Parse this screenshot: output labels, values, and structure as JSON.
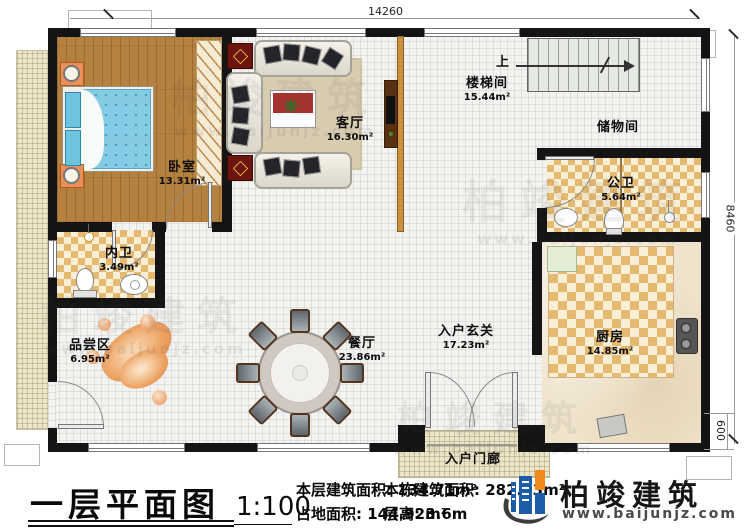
{
  "floorplan": {
    "dim_top": "14260",
    "dim_right": "8460",
    "dim_porch": "600",
    "stairs_up": "上",
    "rooms": {
      "bedroom": {
        "name": "卧室",
        "area": "13.31m²"
      },
      "living": {
        "name": "客厅",
        "area": "16.30m²"
      },
      "stairwell": {
        "name": "楼梯间",
        "area": "15.44m²"
      },
      "storage": {
        "name": "储物间"
      },
      "public_bath": {
        "name": "公卫",
        "area": "5.64m²"
      },
      "private_bath": {
        "name": "内卫",
        "area": "3.49m²"
      },
      "tasting": {
        "name": "品尝区",
        "area": "6.95m²"
      },
      "dining": {
        "name": "餐厅",
        "area": "23.86m²"
      },
      "foyer": {
        "name": "入户玄关",
        "area": "17.23m²"
      },
      "kitchen": {
        "name": "厨房",
        "area": "14.85m²"
      },
      "porch": {
        "name": "入户门廊"
      }
    }
  },
  "footer": {
    "title": "一层平面图",
    "scale": "1:100",
    "stats": {
      "floor_area_label": "本层建筑面积:",
      "floor_area_value": "134.71m²",
      "land_area_label": "占地面积:",
      "land_area_value": "144.92m²",
      "total_area_label": "本栋建筑面积:",
      "total_area_value": "282.03m²",
      "height_label": "层高:",
      "height_value": "3.6m"
    },
    "brand": {
      "name": "柏竣建筑",
      "website": "www.baijunjz.com"
    }
  },
  "watermark": {
    "name": "柏竣建筑",
    "website": "www.baijunjz.com"
  },
  "colors": {
    "accent_blue": "#1c5ca8",
    "accent_orange": "#f08a1d",
    "wall": "#141414"
  }
}
